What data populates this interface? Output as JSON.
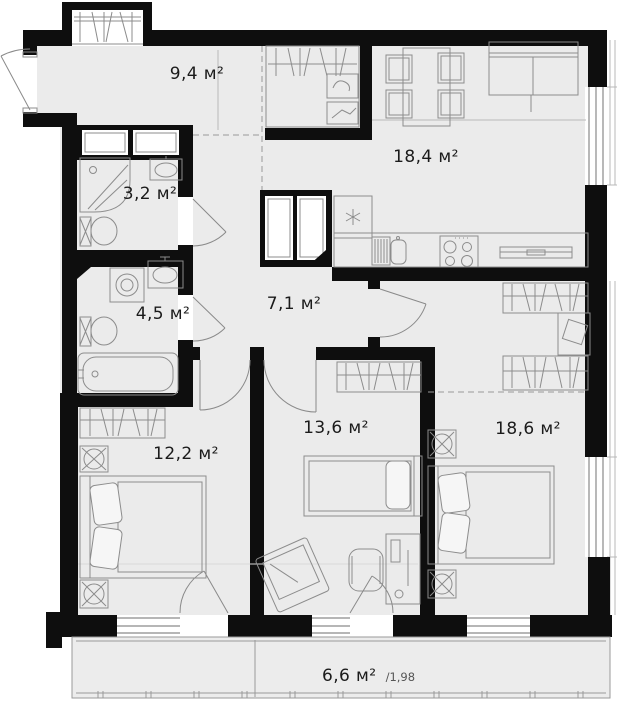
{
  "colors": {
    "wall": "#0e0e0e",
    "room_fill": "#ebebeb",
    "balcony_fill": "#ececec",
    "furniture_line": "#8c8c8c",
    "label_text": "#1b1b1b",
    "background": "#ffffff"
  },
  "rooms": [
    {
      "id": "hallway",
      "label": "9,4 м²"
    },
    {
      "id": "kitchen_living",
      "label": "18,4 м²"
    },
    {
      "id": "bathroom_small",
      "label": "3,2 м²"
    },
    {
      "id": "bathroom",
      "label": "4,5 м²"
    },
    {
      "id": "corridor",
      "label": "7,1 м²"
    },
    {
      "id": "bedroom_left",
      "label": "12,2 м²"
    },
    {
      "id": "bedroom_middle",
      "label": "13,6 м²"
    },
    {
      "id": "bedroom_right",
      "label": "18,6 м²"
    },
    {
      "id": "balcony",
      "label": "6,6 м²",
      "coefficient": "/1,98"
    }
  ]
}
